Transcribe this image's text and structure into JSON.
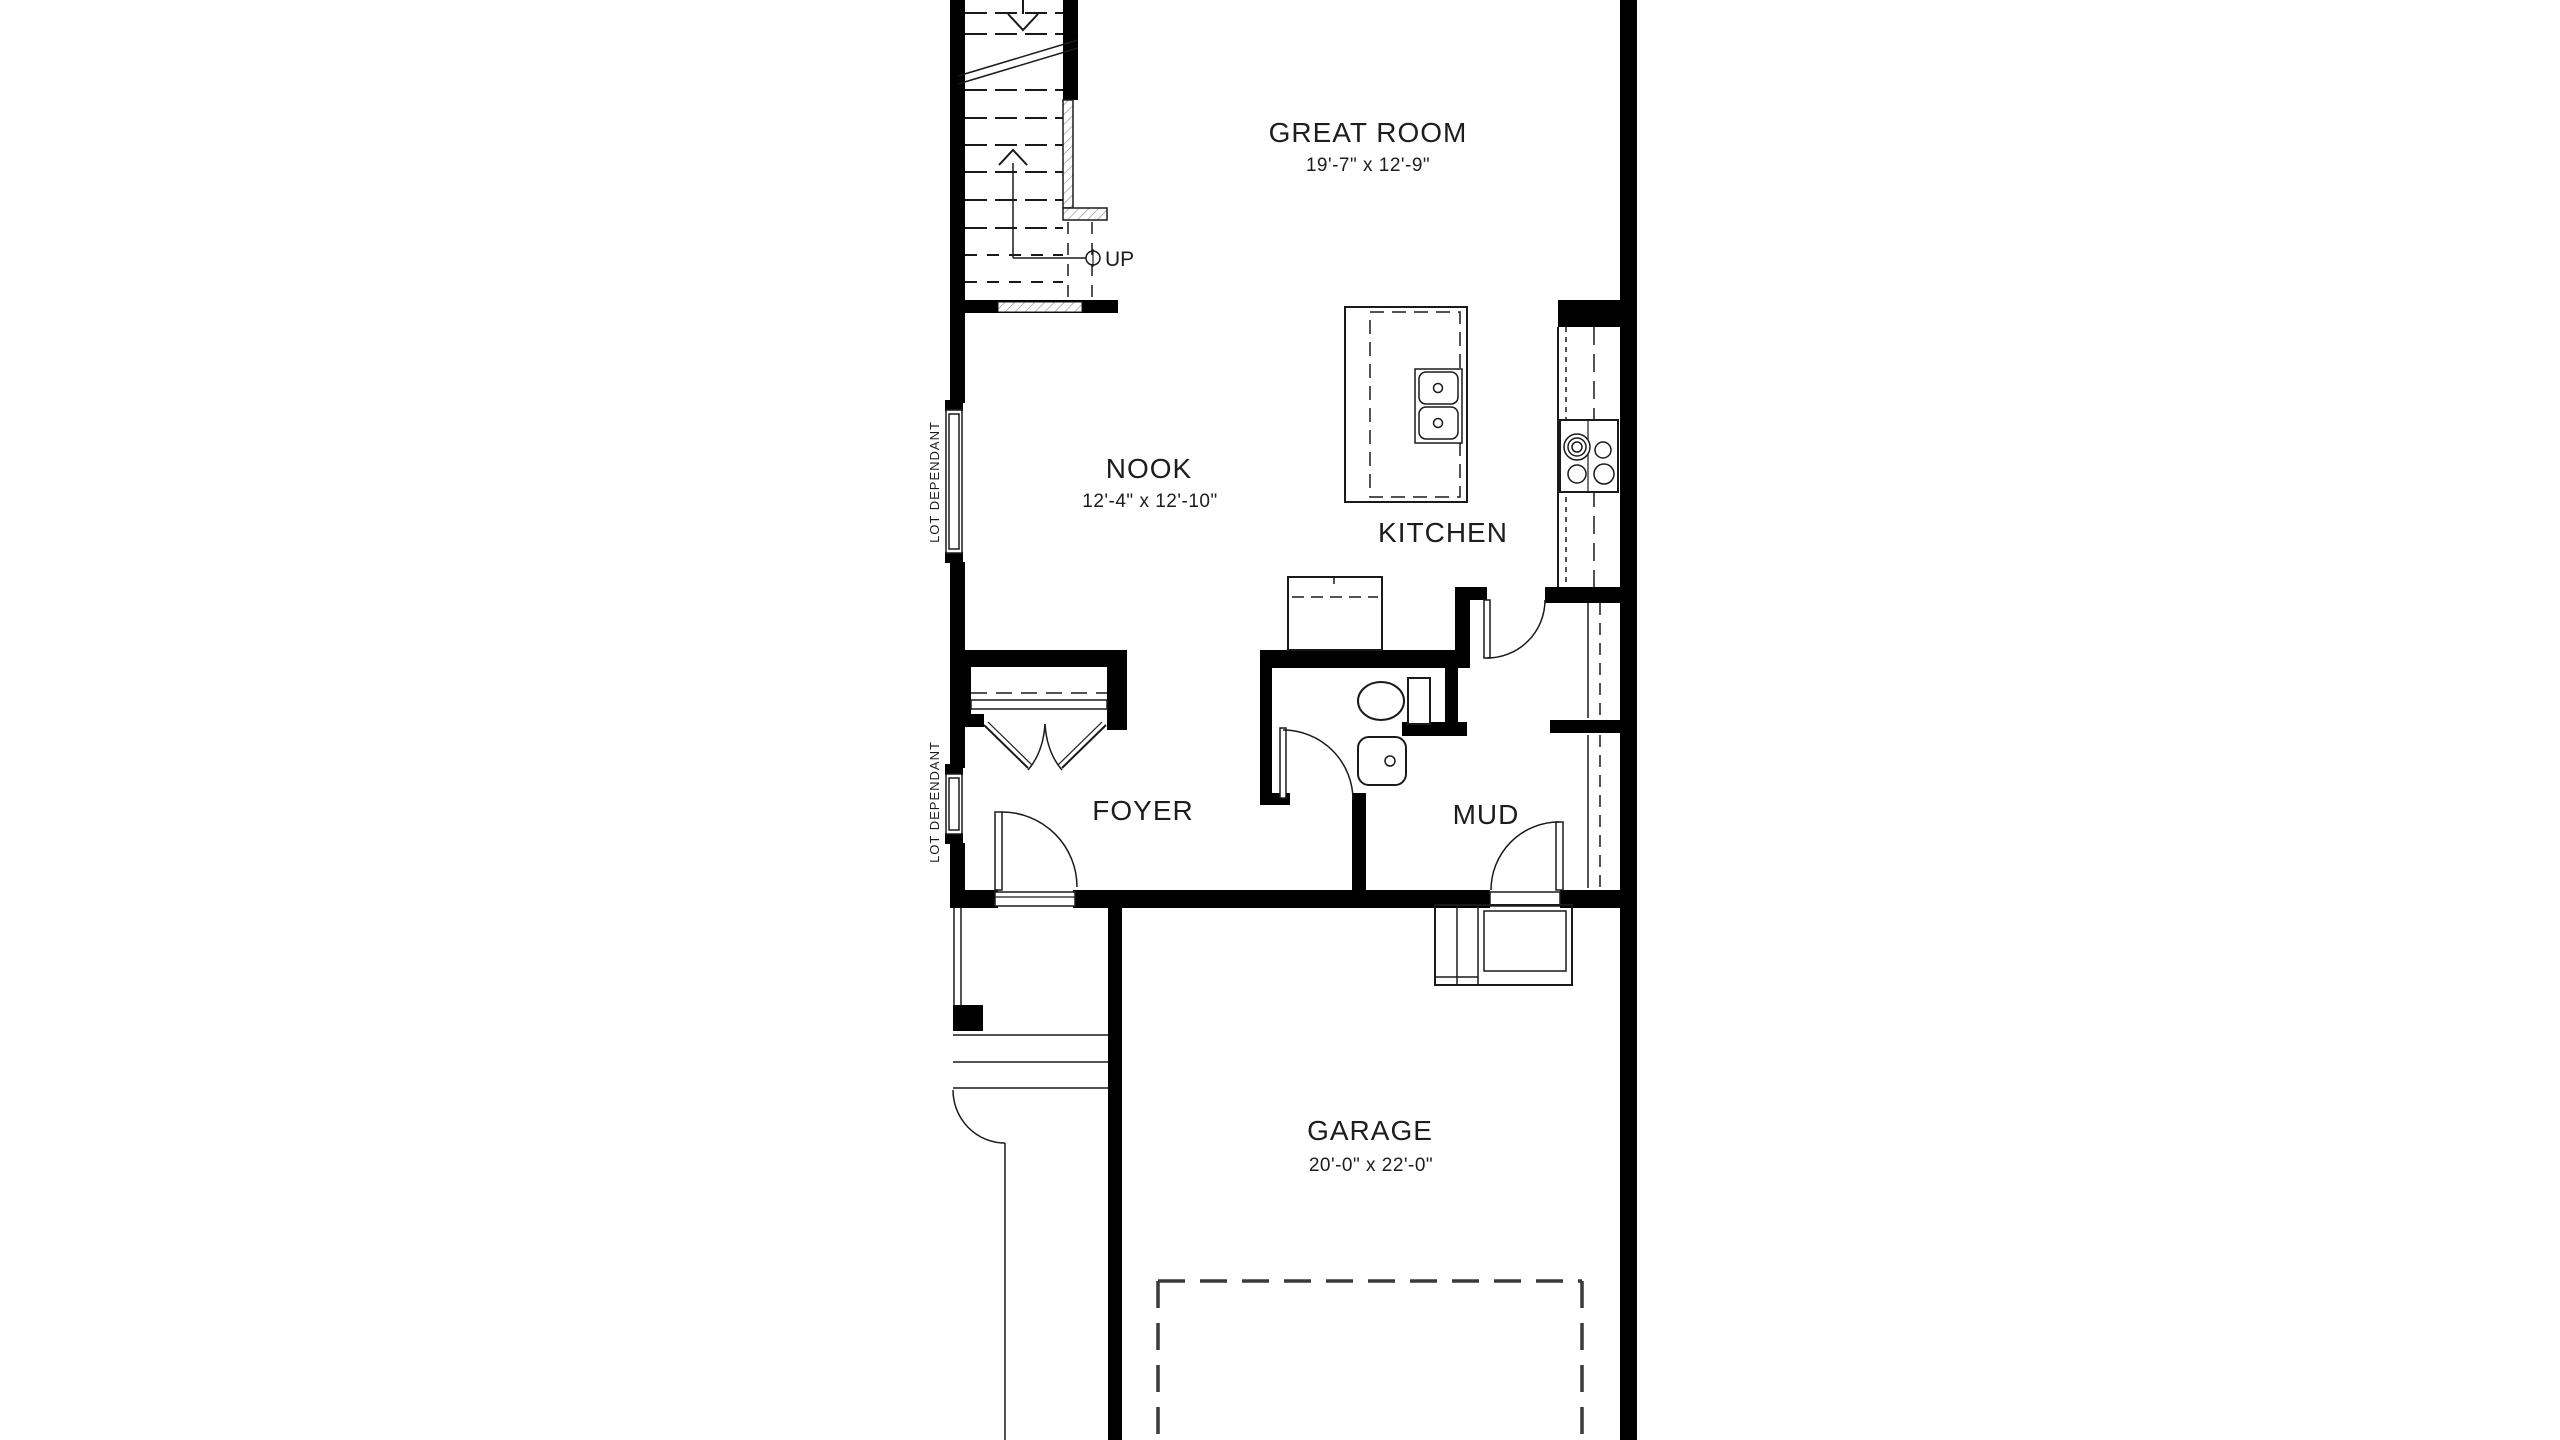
{
  "rooms": {
    "great_room": {
      "name": "GREAT ROOM",
      "dims": "19'-7\" x 12'-9\""
    },
    "nook": {
      "name": "NOOK",
      "dims": "12'-4\" x 12'-10\""
    },
    "kitchen": {
      "name": "KITCHEN"
    },
    "foyer": {
      "name": "FOYER"
    },
    "mud": {
      "name": "MUD"
    },
    "garage": {
      "name": "GARAGE",
      "dims": "20'-0\" x 22'-0\""
    }
  },
  "stairs": {
    "direction_label": "UP"
  },
  "windows": {
    "lot_dependant": "LOT DEPENDANT"
  },
  "colors": {
    "wall": "#000000",
    "line": "#1a1a1a",
    "text": "#1d1d1d",
    "background": "#ffffff"
  }
}
